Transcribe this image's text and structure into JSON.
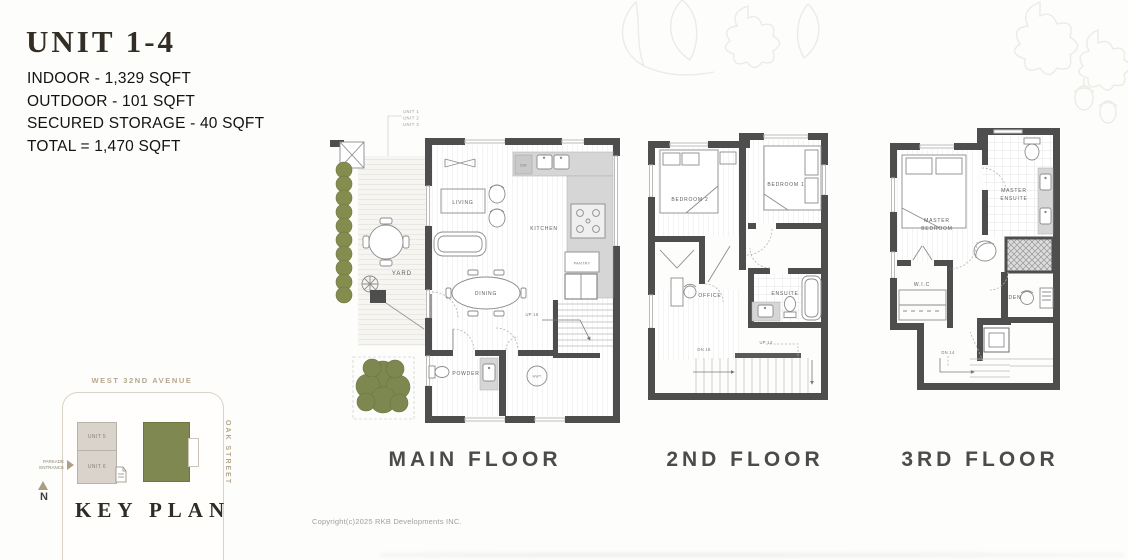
{
  "header": {
    "title": "UNIT 1-4",
    "stats": [
      "INDOOR - 1,329 SQFT",
      "OUTDOOR - 101 SQFT",
      "SECURED STORAGE - 40 SQFT",
      "TOTAL = 1,470 SQFT"
    ]
  },
  "floors": {
    "main": {
      "label": "MAIN FLOOR",
      "callout": [
        "UNIT 1",
        "UNIT 2",
        "UNIT 3"
      ],
      "rooms": {
        "living": "LIVING",
        "kitchen": "KITCHEN",
        "dining": "DINING",
        "yard": "YARD",
        "powder": "POWDER",
        "pantry": "PANTRY"
      },
      "ann": {
        "up": "UP 16",
        "hwt": "HWT",
        "dw": "DW"
      }
    },
    "second": {
      "label": "2ND FLOOR",
      "rooms": {
        "bedroom2": "BEDROOM 2",
        "bedroom1": "BEDROOM 1",
        "office": "OFFICE",
        "ensuite": "ENSUITE"
      },
      "ann": {
        "up": "UP 14",
        "dn": "DN 16"
      }
    },
    "third": {
      "label": "3RD FLOOR",
      "rooms": {
        "master_bedroom": [
          "MASTER",
          "BEDROOM"
        ],
        "master_ensuite": [
          "MASTER",
          "ENSUITE"
        ],
        "wic": "W.I.C",
        "den": "DEN"
      },
      "ann": {
        "dn": "DN 14"
      }
    }
  },
  "key_plan": {
    "title": "KEY PLAN",
    "street_top": "WEST 32ND AVENUE",
    "street_right": "OAK STREET",
    "unit5": "UNIT 5",
    "unit6": "UNIT 6",
    "parkade": [
      "PARKADE",
      "ENTRANCE"
    ],
    "north": "N"
  },
  "footer": {
    "copyright": "Copyright(c)2025 RKB Developments INC."
  },
  "colors": {
    "wall": "#4e4e4e",
    "hedge_green": "#848d4e",
    "keyplan_green": "#7f8850",
    "street_taupe": "#b5a78f"
  }
}
